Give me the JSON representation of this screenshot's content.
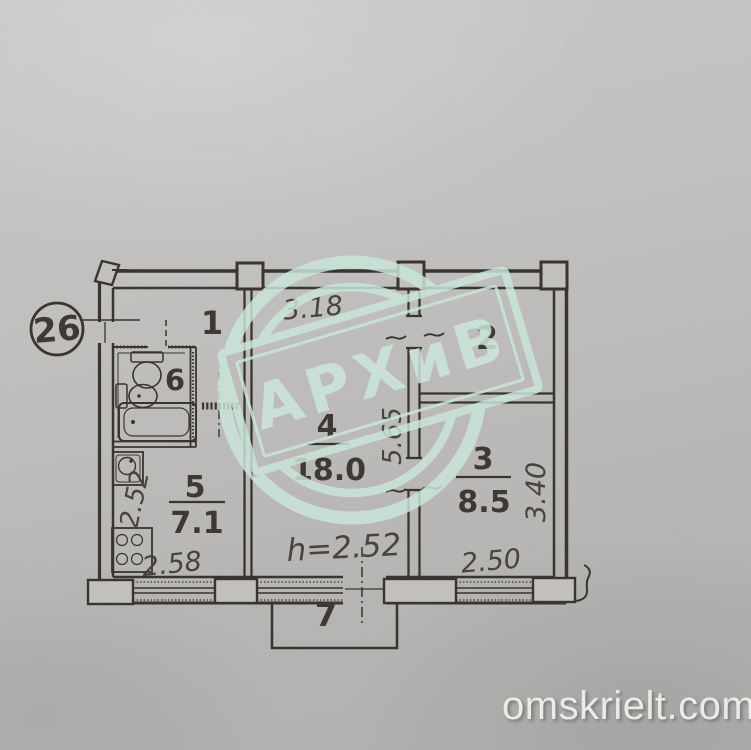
{
  "paper": {
    "background": "#bcbbb9",
    "line_color": "#35312c"
  },
  "callout": {
    "apartment_number": "26"
  },
  "rooms": {
    "room1": {
      "label": "1"
    },
    "room2": {
      "label": "2"
    },
    "room3": {
      "label": "3",
      "area": "8.5"
    },
    "room4": {
      "label": "4",
      "area": "18.0"
    },
    "room5": {
      "label": "5",
      "area": "7.1"
    },
    "room6": {
      "label": "6"
    },
    "room7": {
      "label": "7"
    }
  },
  "dimensions": {
    "top_width": "3.18",
    "center_depth": "5.65",
    "right_depth": "3.40",
    "kitchen_depth": "2.52",
    "kitchen_width": "2.58",
    "room3_width": "2.50",
    "ceiling_height": "h=2.52"
  },
  "stamp": {
    "text": "АРХиВ",
    "color": "#cbe7db"
  },
  "watermark": {
    "text": "omskrielt.com"
  }
}
